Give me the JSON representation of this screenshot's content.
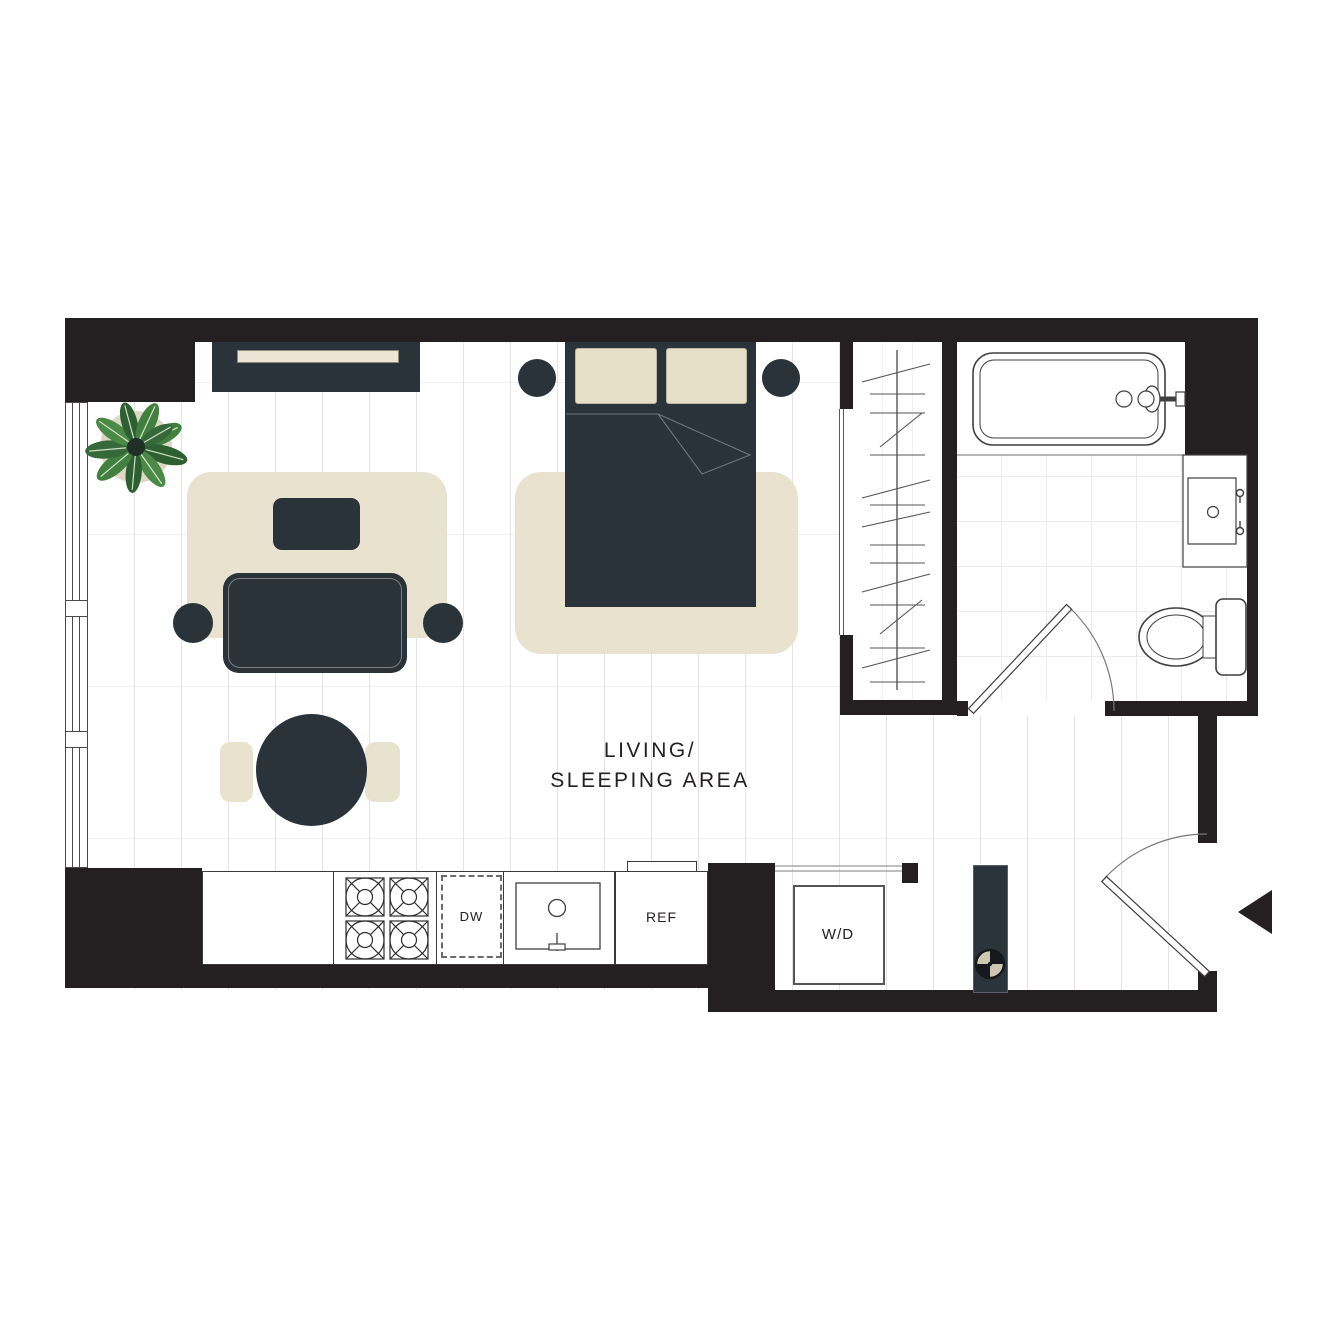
{
  "floor_plan": {
    "area_label": {
      "line1": "LIVING/",
      "line2": "SLEEPING AREA"
    },
    "appliance_labels": {
      "dishwasher": "DW",
      "refrigerator": "REF",
      "washer_dryer": "W/D"
    },
    "rooms": [
      "living-sleeping-area",
      "closet",
      "bathroom",
      "kitchen",
      "entry-hall",
      "laundry-alcove"
    ],
    "colors": {
      "wall_black": "#241f21",
      "furniture_charcoal": "#2a323a",
      "rug_cream": "#e8e2cf",
      "pillow_cream": "#e6dfc8",
      "shelf_cream": "#ece5d6",
      "plant_green": "#41803f",
      "plant_green_dark": "#2e5f33",
      "plant_pot": "#ddd7c3",
      "fixture_line": "#3f3f3f",
      "floor_white": "#ffffff"
    },
    "furniture": [
      "tv-console",
      "plant",
      "sofa",
      "coffee-table",
      "sofa-rug",
      "side-table-left",
      "side-table-right",
      "dining-table",
      "dining-chair-left",
      "dining-chair-right",
      "bed",
      "pillow-left",
      "pillow-right",
      "nightstand-left",
      "nightstand-right",
      "bed-rug"
    ],
    "fixtures": [
      "window-wall",
      "sliding-closet-door",
      "closet-hanging-rod",
      "bathtub",
      "tub-faucet",
      "vanity-sink",
      "toilet",
      "bathroom-door",
      "entry-door",
      "entry-marker",
      "stove",
      "kitchen-sink",
      "dishwasher",
      "refrigerator",
      "washer-dryer",
      "utility-column"
    ]
  }
}
